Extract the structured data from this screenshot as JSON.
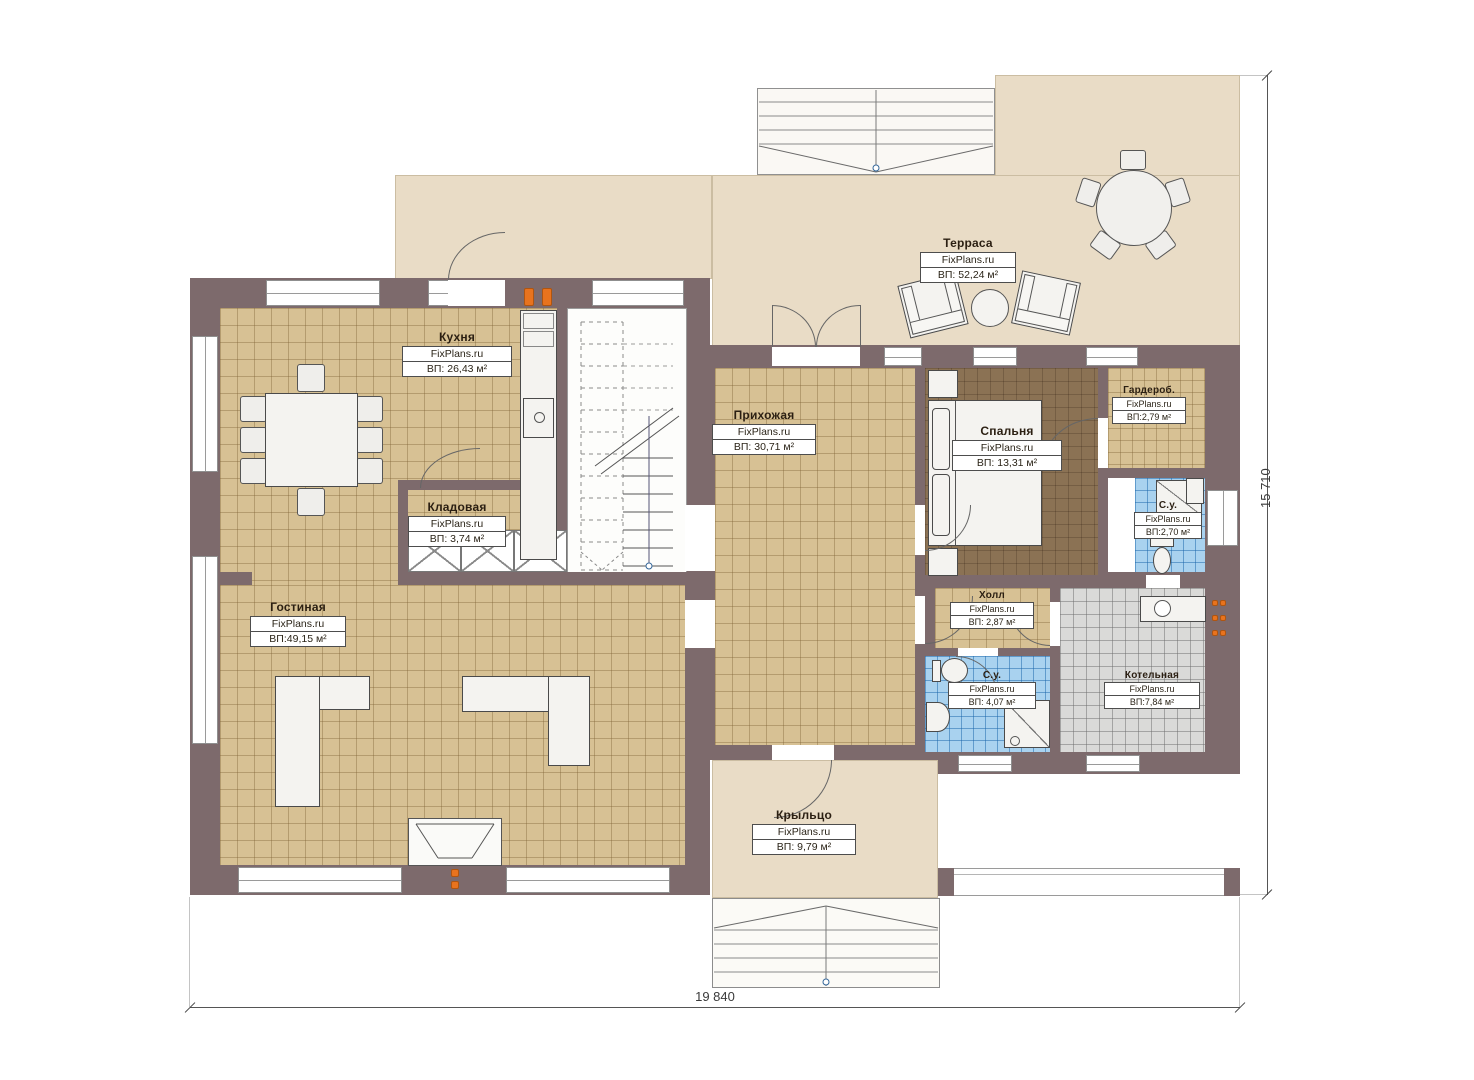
{
  "brand": "FixPlans.ru",
  "dimensions": {
    "width_label": "19 840",
    "height_label": "15 710"
  },
  "rooms": [
    {
      "id": "terrace",
      "name": "Терраса",
      "brand": "FixPlans.ru",
      "area": "ВП: 52,24 м²"
    },
    {
      "id": "kitchen",
      "name": "Кухня",
      "brand": "FixPlans.ru",
      "area": "ВП: 26,43 м²"
    },
    {
      "id": "pantry",
      "name": "Кладовая",
      "brand": "FixPlans.ru",
      "area": "ВП: 3,74 м²"
    },
    {
      "id": "living-room",
      "name": "Гостиная",
      "brand": "FixPlans.ru",
      "area": "ВП:49,15 м²"
    },
    {
      "id": "entry-hall",
      "name": "Прихожая",
      "brand": "FixPlans.ru",
      "area": "ВП: 30,71 м²"
    },
    {
      "id": "bedroom",
      "name": "Спальня",
      "brand": "FixPlans.ru",
      "area": "ВП: 13,31 м²"
    },
    {
      "id": "wardrobe",
      "name": "Гардероб.",
      "brand": "FixPlans.ru",
      "area": "ВП:2,79 м²"
    },
    {
      "id": "bathroom-top",
      "name": "С.у.",
      "brand": "FixPlans.ru",
      "area": "ВП:2,70 м²"
    },
    {
      "id": "hall",
      "name": "Холл",
      "brand": "FixPlans.ru",
      "area": "ВП: 2,87 м²"
    },
    {
      "id": "bathroom-bottom",
      "name": "С.у.",
      "brand": "FixPlans.ru",
      "area": "ВП: 4,07 м²"
    },
    {
      "id": "boiler-room",
      "name": "Котельная",
      "brand": "FixPlans.ru",
      "area": "ВП:7,84 м²"
    },
    {
      "id": "porch",
      "name": "Крыльцо",
      "brand": "FixPlans.ru",
      "area": "ВП: 9,79 м²"
    }
  ],
  "colors": {
    "wall": "#7d6a6c",
    "floor_tile_tan": "#d7c194",
    "floor_wood_brown": "#8b7254",
    "floor_tile_blue": "#a9d2ef",
    "floor_tile_gray": "#dadad8",
    "terrace_beige": "#e9dcc6",
    "accent_orange": "#e8731e"
  }
}
